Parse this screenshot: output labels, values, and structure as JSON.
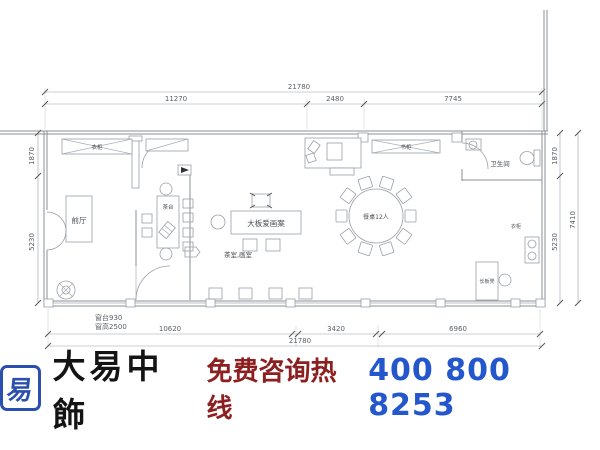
{
  "drawing": {
    "dim_top_total": "21780",
    "dim_top_segments": [
      "11270",
      "2480",
      "7745"
    ],
    "dim_bottom_segments": [
      "10620",
      "3420",
      "6960"
    ],
    "dim_bottom_total": "21780",
    "dim_left_segments": [
      "1870",
      "5230"
    ],
    "dim_right_segments": [
      "1870",
      "5230"
    ],
    "dim_right_total": "7410",
    "window_note_line1": "窗台930",
    "window_note_line2": "窗高2500",
    "labels": {
      "front_hall": "前厅",
      "wardrobe_top": "衣柜",
      "bookcase_top": "书柜",
      "tea_table": "茶台",
      "big_slab_table": "大板爱画案",
      "tea_paint_room": "茶室,画室",
      "round_table": "餐桌12人",
      "bathroom": "卫生间",
      "right_wall_cabinet": "衣柜",
      "bench": "长板凳"
    }
  },
  "footer": {
    "logo_char": "易",
    "brand": "大易中飾",
    "hotline_label": "免费咨询热线",
    "phone": "400 800 8253",
    "logo_blue": "#2b4fae",
    "hotline_red": "#8c1f1f",
    "phone_blue": "#2456cc"
  }
}
